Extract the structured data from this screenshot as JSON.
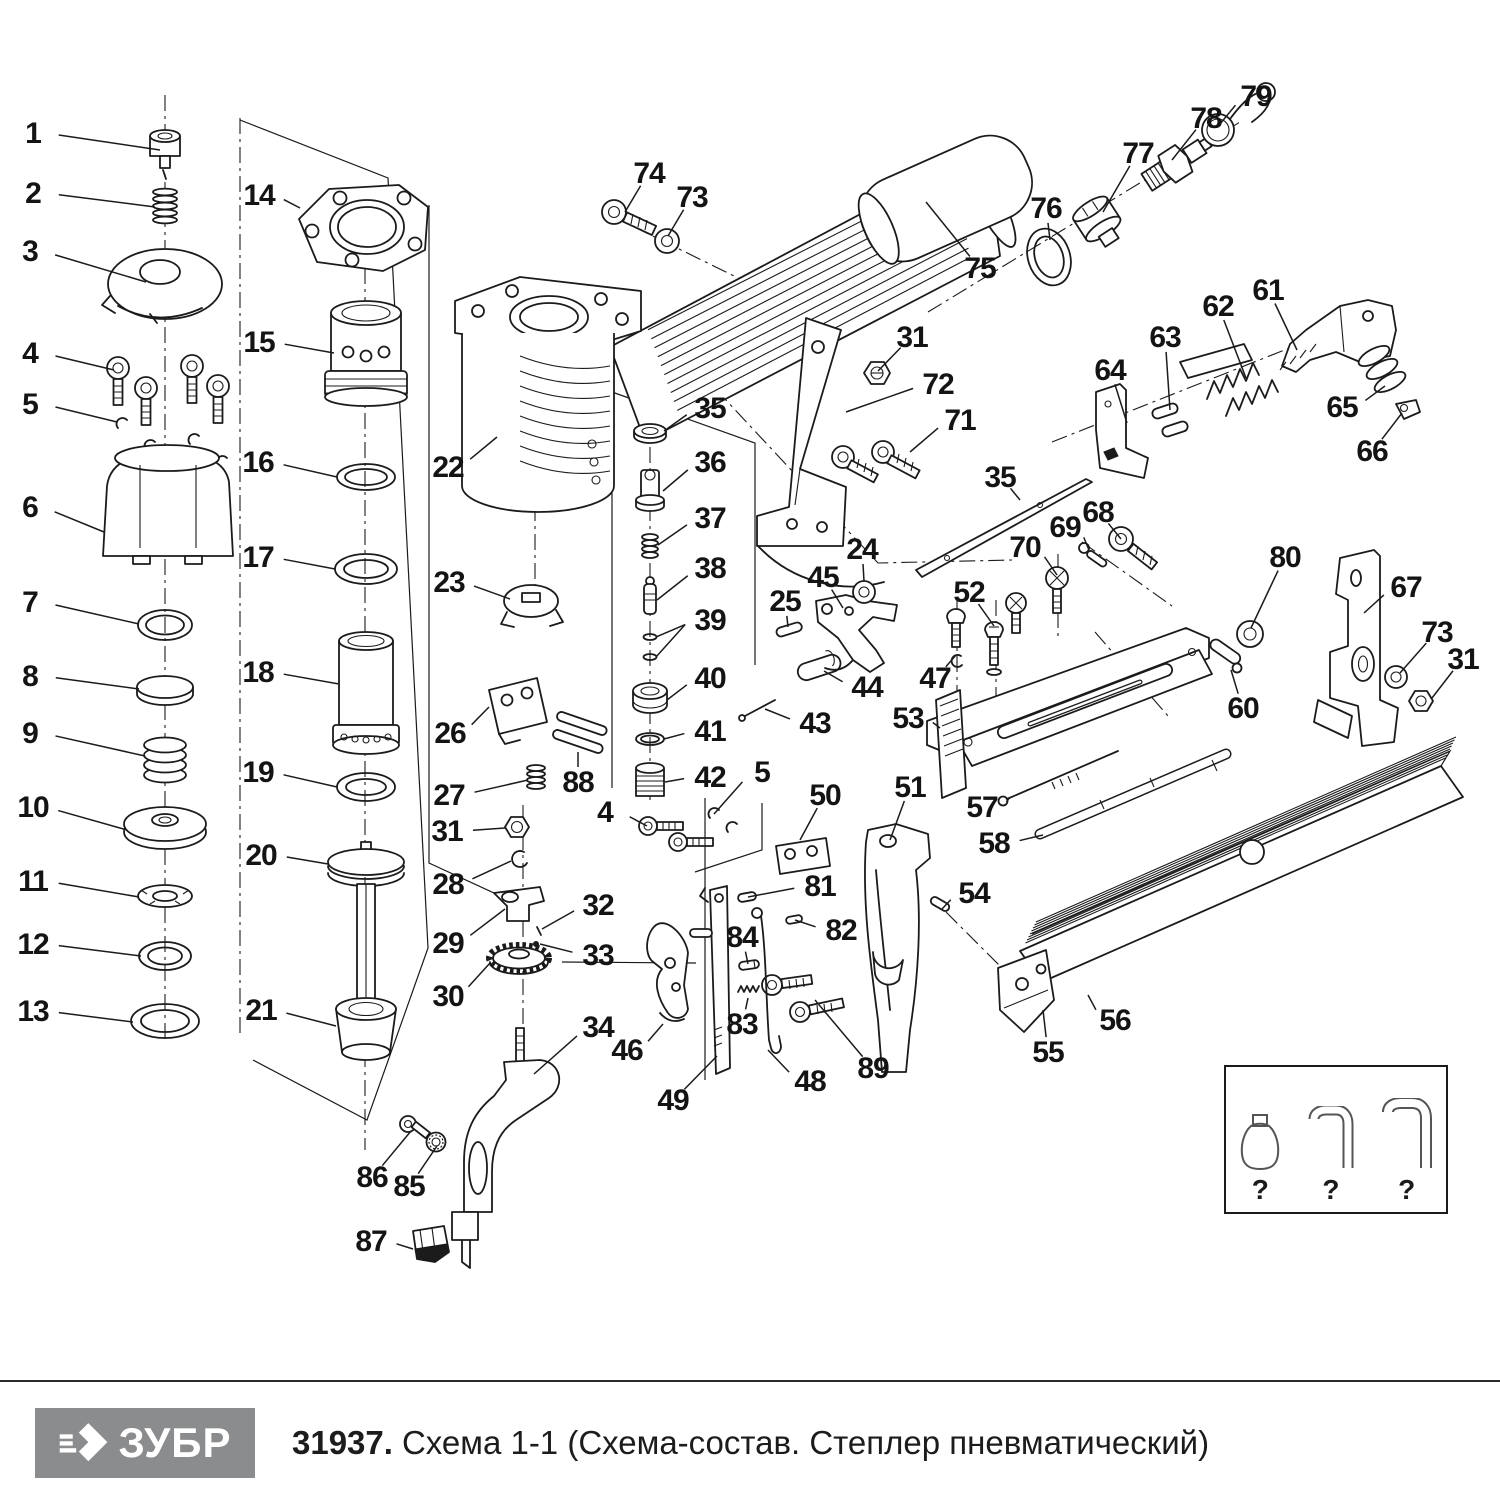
{
  "footer": {
    "brand": "ЗУБР",
    "title_bold": "31937.",
    "title_rest": "Схема 1-1 (Схема-состав. Степлер пневматический)"
  },
  "accessories": {
    "items": [
      {
        "icon": "oil-bottle",
        "label": "?"
      },
      {
        "icon": "hex-key",
        "label": "?"
      },
      {
        "icon": "hex-key",
        "label": "?"
      }
    ]
  },
  "diagram": {
    "description": "Exploded parts diagram of pneumatic stapler, parts 1-89",
    "labels": [
      [
        "1",
        33,
        133,
        160,
        150
      ],
      [
        "2",
        33,
        193,
        155,
        207
      ],
      [
        "3",
        30,
        251,
        146,
        282
      ],
      [
        "4",
        30,
        353,
        114,
        370
      ],
      [
        "5",
        30,
        404,
        117,
        422
      ],
      [
        "6",
        30,
        507,
        104,
        532
      ],
      [
        "7",
        30,
        602,
        139,
        624
      ],
      [
        "8",
        30,
        676,
        139,
        689
      ],
      [
        "9",
        30,
        733,
        145,
        756
      ],
      [
        "10",
        33,
        807,
        127,
        830
      ],
      [
        "11",
        33,
        881,
        139,
        897
      ],
      [
        "12",
        33,
        944,
        141,
        956
      ],
      [
        "13",
        33,
        1011,
        133,
        1022
      ],
      [
        "14",
        259,
        195,
        300,
        208
      ],
      [
        "15",
        259,
        342,
        334,
        353
      ],
      [
        "16",
        258,
        462,
        337,
        477
      ],
      [
        "17",
        258,
        557,
        335,
        569
      ],
      [
        "18",
        258,
        672,
        339,
        684
      ],
      [
        "19",
        258,
        772,
        337,
        787
      ],
      [
        "20",
        261,
        855,
        328,
        864
      ],
      [
        "21",
        261,
        1010,
        336,
        1026
      ],
      [
        "22",
        448,
        467,
        497,
        437
      ],
      [
        "23",
        449,
        582,
        510,
        599
      ],
      [
        "24",
        862,
        549,
        864,
        581
      ],
      [
        "25",
        785,
        601,
        788,
        627
      ],
      [
        "26",
        450,
        733,
        489,
        707
      ],
      [
        "27",
        449,
        795,
        528,
        780
      ],
      [
        "28",
        448,
        884,
        511,
        861
      ],
      [
        "29",
        448,
        943,
        505,
        909
      ],
      [
        "30",
        448,
        996,
        490,
        963
      ],
      [
        "31",
        447,
        831,
        505,
        828
      ],
      [
        "31",
        912,
        337,
        878,
        371
      ],
      [
        "31",
        1463,
        659,
        1432,
        698
      ],
      [
        "32",
        598,
        905,
        542,
        929
      ],
      [
        "33",
        598,
        955,
        540,
        944
      ],
      [
        "34",
        598,
        1027,
        534,
        1074
      ],
      [
        "35",
        710,
        408,
        664,
        431
      ],
      [
        "35",
        1000,
        477,
        1020,
        500
      ],
      [
        "36",
        710,
        462,
        663,
        491
      ],
      [
        "37",
        710,
        518,
        658,
        545
      ],
      [
        "38",
        710,
        568,
        657,
        600
      ],
      [
        "39",
        710,
        620,
        656,
        637,
        656,
        657
      ],
      [
        "40",
        710,
        678,
        667,
        700
      ],
      [
        "41",
        710,
        731,
        664,
        739
      ],
      [
        "42",
        710,
        777,
        665,
        782
      ],
      [
        "43",
        815,
        723,
        765,
        709
      ],
      [
        "44",
        867,
        687,
        824,
        671
      ],
      [
        "45",
        823,
        577,
        843,
        608
      ],
      [
        "46",
        627,
        1050,
        663,
        1024
      ],
      [
        "47",
        935,
        678,
        956,
        655
      ],
      [
        "48",
        810,
        1081,
        768,
        1050
      ],
      [
        "49",
        673,
        1100,
        717,
        1056
      ],
      [
        "50",
        825,
        795,
        800,
        840
      ],
      [
        "51",
        910,
        787,
        890,
        840
      ],
      [
        "52",
        969,
        592,
        994,
        626
      ],
      [
        "53",
        908,
        718,
        940,
        728
      ],
      [
        "54",
        974,
        893,
        942,
        909
      ],
      [
        "55",
        1048,
        1052,
        1043,
        1010
      ],
      [
        "56",
        1115,
        1020,
        1088,
        995
      ],
      [
        "57",
        982,
        807,
        1010,
        797
      ],
      [
        "58",
        994,
        843,
        1043,
        835
      ],
      [
        "60",
        1243,
        708,
        1231,
        670
      ],
      [
        "61",
        1268,
        290,
        1297,
        350
      ],
      [
        "62",
        1218,
        306,
        1246,
        378
      ],
      [
        "63",
        1165,
        337,
        1170,
        410
      ],
      [
        "64",
        1110,
        370,
        1127,
        423
      ],
      [
        "65",
        1342,
        407,
        1385,
        386
      ],
      [
        "66",
        1372,
        451,
        1402,
        413
      ],
      [
        "67",
        1406,
        587,
        1364,
        613
      ],
      [
        "68",
        1098,
        512,
        1121,
        539
      ],
      [
        "69",
        1065,
        527,
        1089,
        550
      ],
      [
        "70",
        1025,
        547,
        1057,
        575
      ],
      [
        "71",
        960,
        420,
        910,
        452
      ],
      [
        "72",
        938,
        384,
        846,
        412
      ],
      [
        "73",
        692,
        197,
        668,
        236
      ],
      [
        "73",
        1437,
        632,
        1400,
        673
      ],
      [
        "74",
        649,
        173,
        625,
        212
      ],
      [
        "75",
        980,
        268,
        926,
        202
      ],
      [
        "76",
        1046,
        208,
        1050,
        240
      ],
      [
        "77",
        1138,
        153,
        1103,
        212
      ],
      [
        "78",
        1206,
        118,
        1172,
        160
      ],
      [
        "79",
        1256,
        96,
        1220,
        124
      ],
      [
        "80",
        1285,
        557,
        1251,
        628
      ],
      [
        "81",
        820,
        886,
        748,
        897
      ],
      [
        "82",
        841,
        930,
        795,
        920
      ],
      [
        "83",
        742,
        1024,
        748,
        998
      ],
      [
        "84",
        742,
        937,
        748,
        964
      ],
      [
        "85",
        409,
        1186,
        437,
        1146
      ],
      [
        "86",
        372,
        1177,
        411,
        1131
      ],
      [
        "87",
        371,
        1241,
        413,
        1249
      ],
      [
        "88",
        578,
        782,
        578,
        752
      ],
      [
        "89",
        873,
        1068,
        815,
        1000
      ],
      [
        "4",
        605,
        812,
        647,
        826
      ],
      [
        "5",
        762,
        772,
        714,
        814
      ]
    ]
  }
}
